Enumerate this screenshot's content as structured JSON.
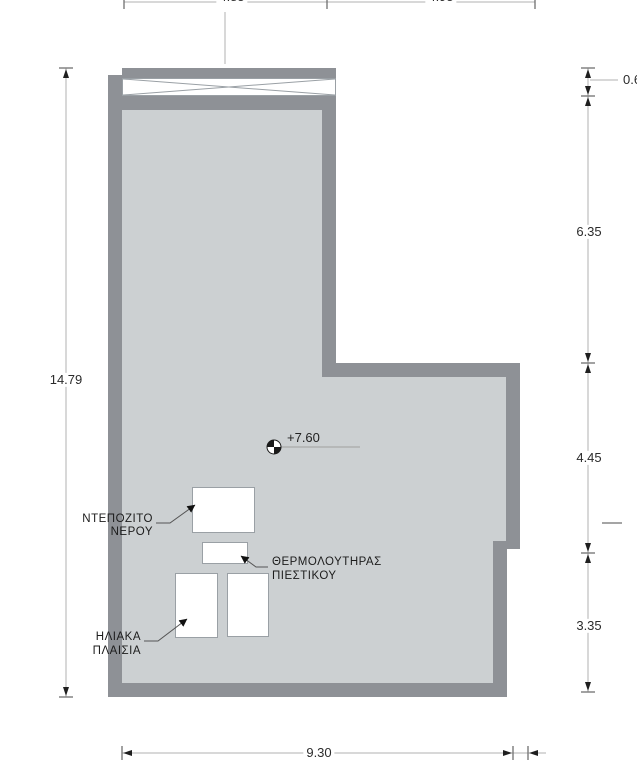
{
  "plan": {
    "level_marker": {
      "value": "+7.60"
    },
    "equipment_labels": {
      "water_tank": {
        "line1": "ΝΤΕΠΟΖΙΤΟ",
        "line2": "ΝΕΡΟΥ"
      },
      "pressure_heater": {
        "line1": "ΘΕΡΜΟΛΟΥΤΗΡΑΣ",
        "line2": "ΠΙΕΣΤΙΚΟΥ"
      },
      "solar_panels": {
        "line1": "ΗΛΙΑΚΑ",
        "line2": "ΠΛΑΙΣΙΑ"
      }
    },
    "dimensions": {
      "left_total_height": "14.79",
      "right_parapet": "0.6",
      "right_upper": "6.35",
      "right_middle": "4.45",
      "right_lower": "3.35",
      "bottom_width": "9.30",
      "top_segment_left_clipped": "4.85",
      "top_segment_right_clipped": "4.95"
    },
    "colors": {
      "wall": "#8e9196",
      "floor": "#ccd0d2",
      "dim_line": "#b2b2b2",
      "text": "#2b2b2b"
    }
  }
}
